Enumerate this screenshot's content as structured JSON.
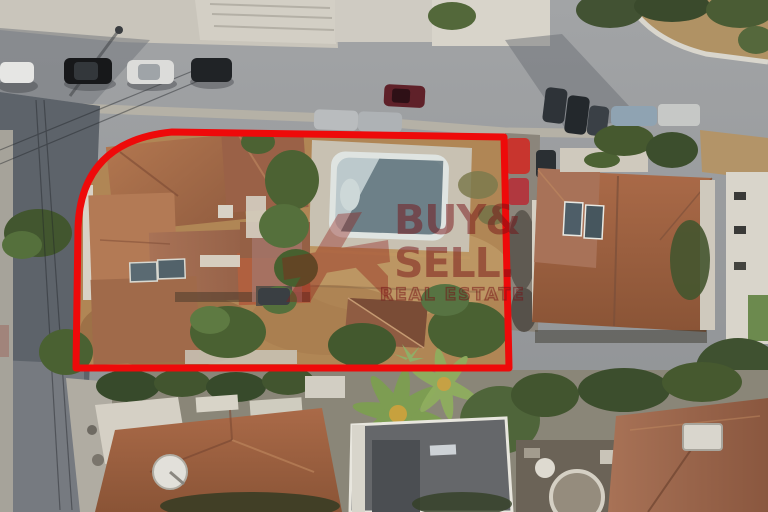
{
  "photo": {
    "kind": "aerial-drone-photo",
    "subject": "residential corner plot with house, garden and empty swimming pool outlined in red",
    "setting": "suburban street with terracotta-roof houses, roads, trees and parked cars"
  },
  "watermark": {
    "line1": "BUY&",
    "line2": "SELL.",
    "line3": "REAL ESTATE",
    "color": "#76161a",
    "logo": "abstract-red-angular-mark"
  },
  "boundary": {
    "color": "#ee0a0a",
    "shape": "rectangle with rounded top-left corner",
    "label": "highlighted property plot"
  },
  "palette": {
    "terracotta_roof": "#a36a4b",
    "asphalt": "#97999b",
    "shaded_asphalt": "#5d636a",
    "concrete": "#c9c5bb",
    "dry_ground": "#b08655",
    "pool_water": "#bcc9cc",
    "vegetation": "#4c6233"
  },
  "scene_objects": [
    "main-house",
    "empty-swimming-pool",
    "garden-trees",
    "outbuilding",
    "neighbor-house",
    "solar-panels",
    "satellite-dish",
    "parked-cars",
    "roads",
    "palm-trees"
  ]
}
